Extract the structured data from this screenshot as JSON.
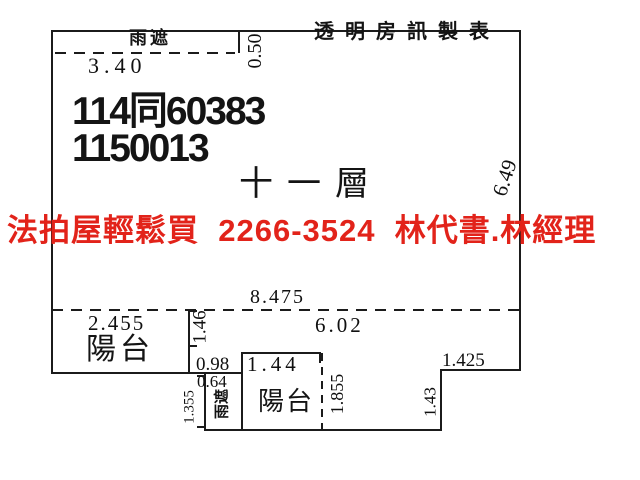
{
  "page": {
    "background": "#ffffff",
    "line_color": "#1b1b1b",
    "accent_red": "#e2231a"
  },
  "header": {
    "maker_label": "透明房訊製表"
  },
  "unit": {
    "case_id_line1": "114同60383",
    "case_id_line2": "1150013",
    "floor_label": "十一層"
  },
  "ad_banner": {
    "text": "法拍屋輕鬆買  2266-3524  林代書.林經理"
  },
  "rooms": {
    "canopy_top_label": "雨遮",
    "canopy_side_label": "雨遮",
    "balcony_left_label": "陽台",
    "balcony_bottom_label": "陽台"
  },
  "dims": {
    "canopy_width": "3.40",
    "canopy_depth": "0.50",
    "right_side_height": "6.49",
    "interior_total_width": "8.475",
    "balcony_left_width": "2.455",
    "interior_right_width": "6.02",
    "notch_depth": "1.46",
    "notch_width": "0.98",
    "balcony_bottom_width": "1.44",
    "canopy_side_width": "0.64",
    "canopy_side_height": "1.355",
    "balcony_bottom_depth": "1.855",
    "step_width": "1.425",
    "step_height": "1.43"
  }
}
